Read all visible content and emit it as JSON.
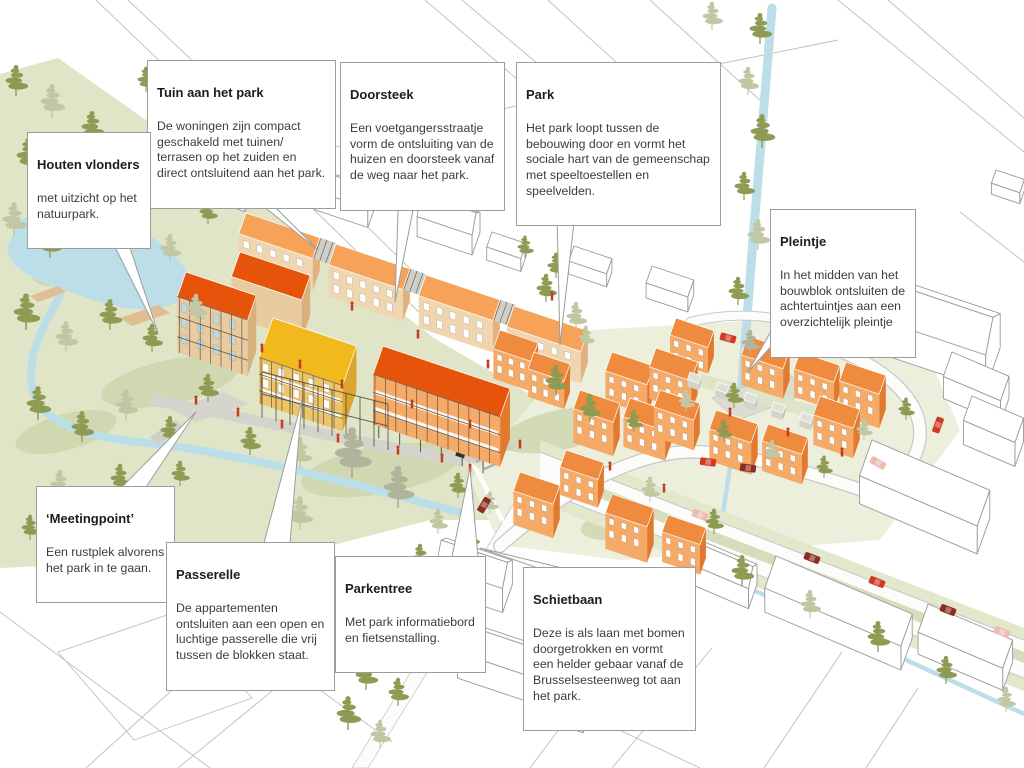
{
  "callouts": [
    {
      "id": "tuin-aan-het-park",
      "title": "Tuin aan het park",
      "body": "De woningen zijn compact\ngeschakeld met tuinen/\nterrasen op het zuiden en\ndirect ontsluitend aan het park."
    },
    {
      "id": "doorsteek",
      "title": "Doorsteek",
      "body": "Een voetgangersstraatje\nvorm de ontsluiting van de\nhuizen en doorsteek vanaf\nde weg naar het park."
    },
    {
      "id": "park",
      "title": "Park",
      "body": "Het park loopt tussen de\nbebouwing door en vormt het\nsociale hart van de gemeenschap\nmet speeltoestellen en\nspeelvelden."
    },
    {
      "id": "houten-vlonders",
      "title": "Houten vlonders",
      "body": "met uitzicht op het\nnatuurpark."
    },
    {
      "id": "pleintje",
      "title": "Pleintje",
      "body": "In het midden van het\nbouwblok ontsluiten de\nachtertuintjes aan een\noverzichtelijk pleintje"
    },
    {
      "id": "meetingpoint",
      "title": "‘Meetingpoint’",
      "body": "Een rustplek alvorens\nhet park in te gaan."
    },
    {
      "id": "passerelle",
      "title": "Passerelle",
      "body": "De appartementen\nontsluiten aan een open en\nluchtige passerelle die vrij\ntussen de blokken staat."
    },
    {
      "id": "parkentree",
      "title": "Parkentree",
      "body": "Met park informatiebord\nen fietsenstalling."
    },
    {
      "id": "schietbaan",
      "title": "Schietbaan",
      "body": "Deze is als laan met bomen\ndoorgetrokken en vormt\neen helder gebaar vanaf de\nBrusselsesteenweg tot aan\nhet park."
    }
  ],
  "palette": {
    "bright_roof": "#E6540C",
    "light_orange_roof": "#F7A259",
    "yellow_roof": "#F2B91D",
    "cube_roof": "#EE8B3E",
    "facade_orange": "#F5AA67",
    "facade_side": "#E17A2E",
    "facade_tan": "#E9CBA0",
    "facade_tan_side": "#D8B07C",
    "facade_yellow": "#EDC468",
    "facade_yellow_side": "#DCA52F",
    "row_front": "#EFD6B0",
    "row_side": "#E2B27E",
    "tree_olive": "#8F9A52",
    "tree_sage": "#C2C7A3",
    "tree_gray": "#AFB49B",
    "park_green": "#E0E5C8",
    "park_light": "#ECEFDC",
    "shrub_green": "#CCD5AC",
    "water_blue": "#BCDEE9",
    "paving_gray": "#D5D4CC",
    "deck_wood": "#DFBE93",
    "car_red": "#CF3A27",
    "car_dark_red": "#8E2B22",
    "car_pink": "#F0B9B2",
    "person_red": "#C23A1E",
    "outline_gray": "#9D9D9C",
    "parcel_line": "#BEBEBE"
  }
}
